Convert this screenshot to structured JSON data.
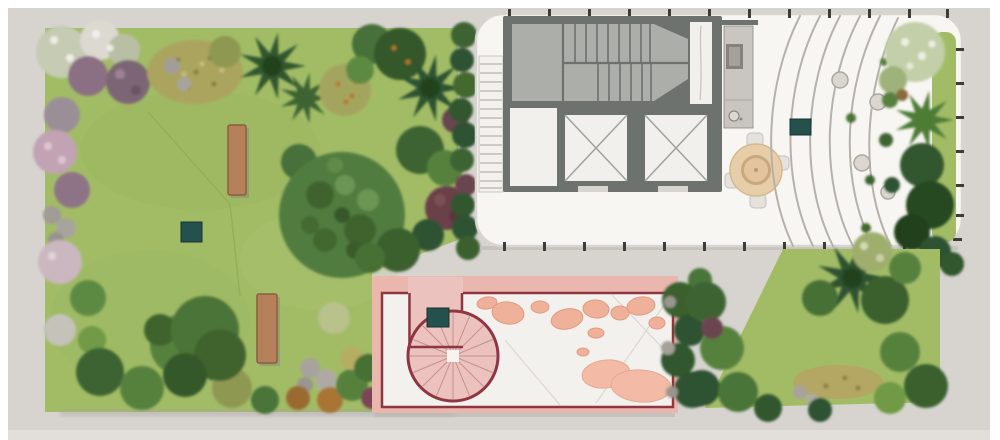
{
  "canvas": {
    "width": 1000,
    "height": 440
  },
  "colors": {
    "page_bg": "#ffffff",
    "surround": "#d7d4d0",
    "surround_light": "#e2dfdb",
    "lawn": "#a2bc66",
    "terrace": "#f8f6f2",
    "terrace_border": "#d8d5d0",
    "railing_tick": "#3c3c3a",
    "wall": "#6e726e",
    "stairwell": "#acafa9",
    "cab_white": "#f2f0ed",
    "elevator_x": "#9fa29c",
    "step_curve": "#b5b2ac",
    "planter": "#dbd7d0",
    "table": "#e8cda9",
    "table_ring": "#c7a97f",
    "courtyard_band": "#eab7ae",
    "courtyard_paving": "#f3f1ee",
    "courtyard_border": "#8e3742",
    "spiral_fill": "#ecc2be",
    "spiral_spoke": "#c9908c",
    "stone": "#f0b19b",
    "stone_big": "#f3bba6",
    "bench": "#b5815b",
    "bench_edge": "#8a5f3e",
    "marker": "#24504e",
    "hedge_dark": "#2f5230",
    "hedge_mid": "#4a7438",
    "hedge_light": "#6f9a44"
  },
  "plan": {
    "markers": [
      {
        "id": "marker-lawn",
        "x": 181,
        "y": 222,
        "width": 21,
        "height": 20
      },
      {
        "id": "marker-terrace",
        "x": 790,
        "y": 119,
        "width": 21,
        "height": 16
      },
      {
        "id": "marker-courtyard",
        "x": 427,
        "y": 308,
        "width": 22,
        "height": 19
      }
    ],
    "benches": [
      {
        "x": 228,
        "y": 125,
        "width": 18,
        "height": 70
      },
      {
        "x": 257,
        "y": 294,
        "width": 20,
        "height": 69
      }
    ],
    "features": [
      "lawn-garden",
      "roof-terrace",
      "stairwell",
      "elevators",
      "kitchenette",
      "dining-table",
      "terrace-step-curves",
      "planters",
      "planting-bed",
      "spiral-staircase",
      "stepping-stone-courtyard",
      "benches",
      "hedges",
      "palm-trees",
      "markers"
    ]
  }
}
